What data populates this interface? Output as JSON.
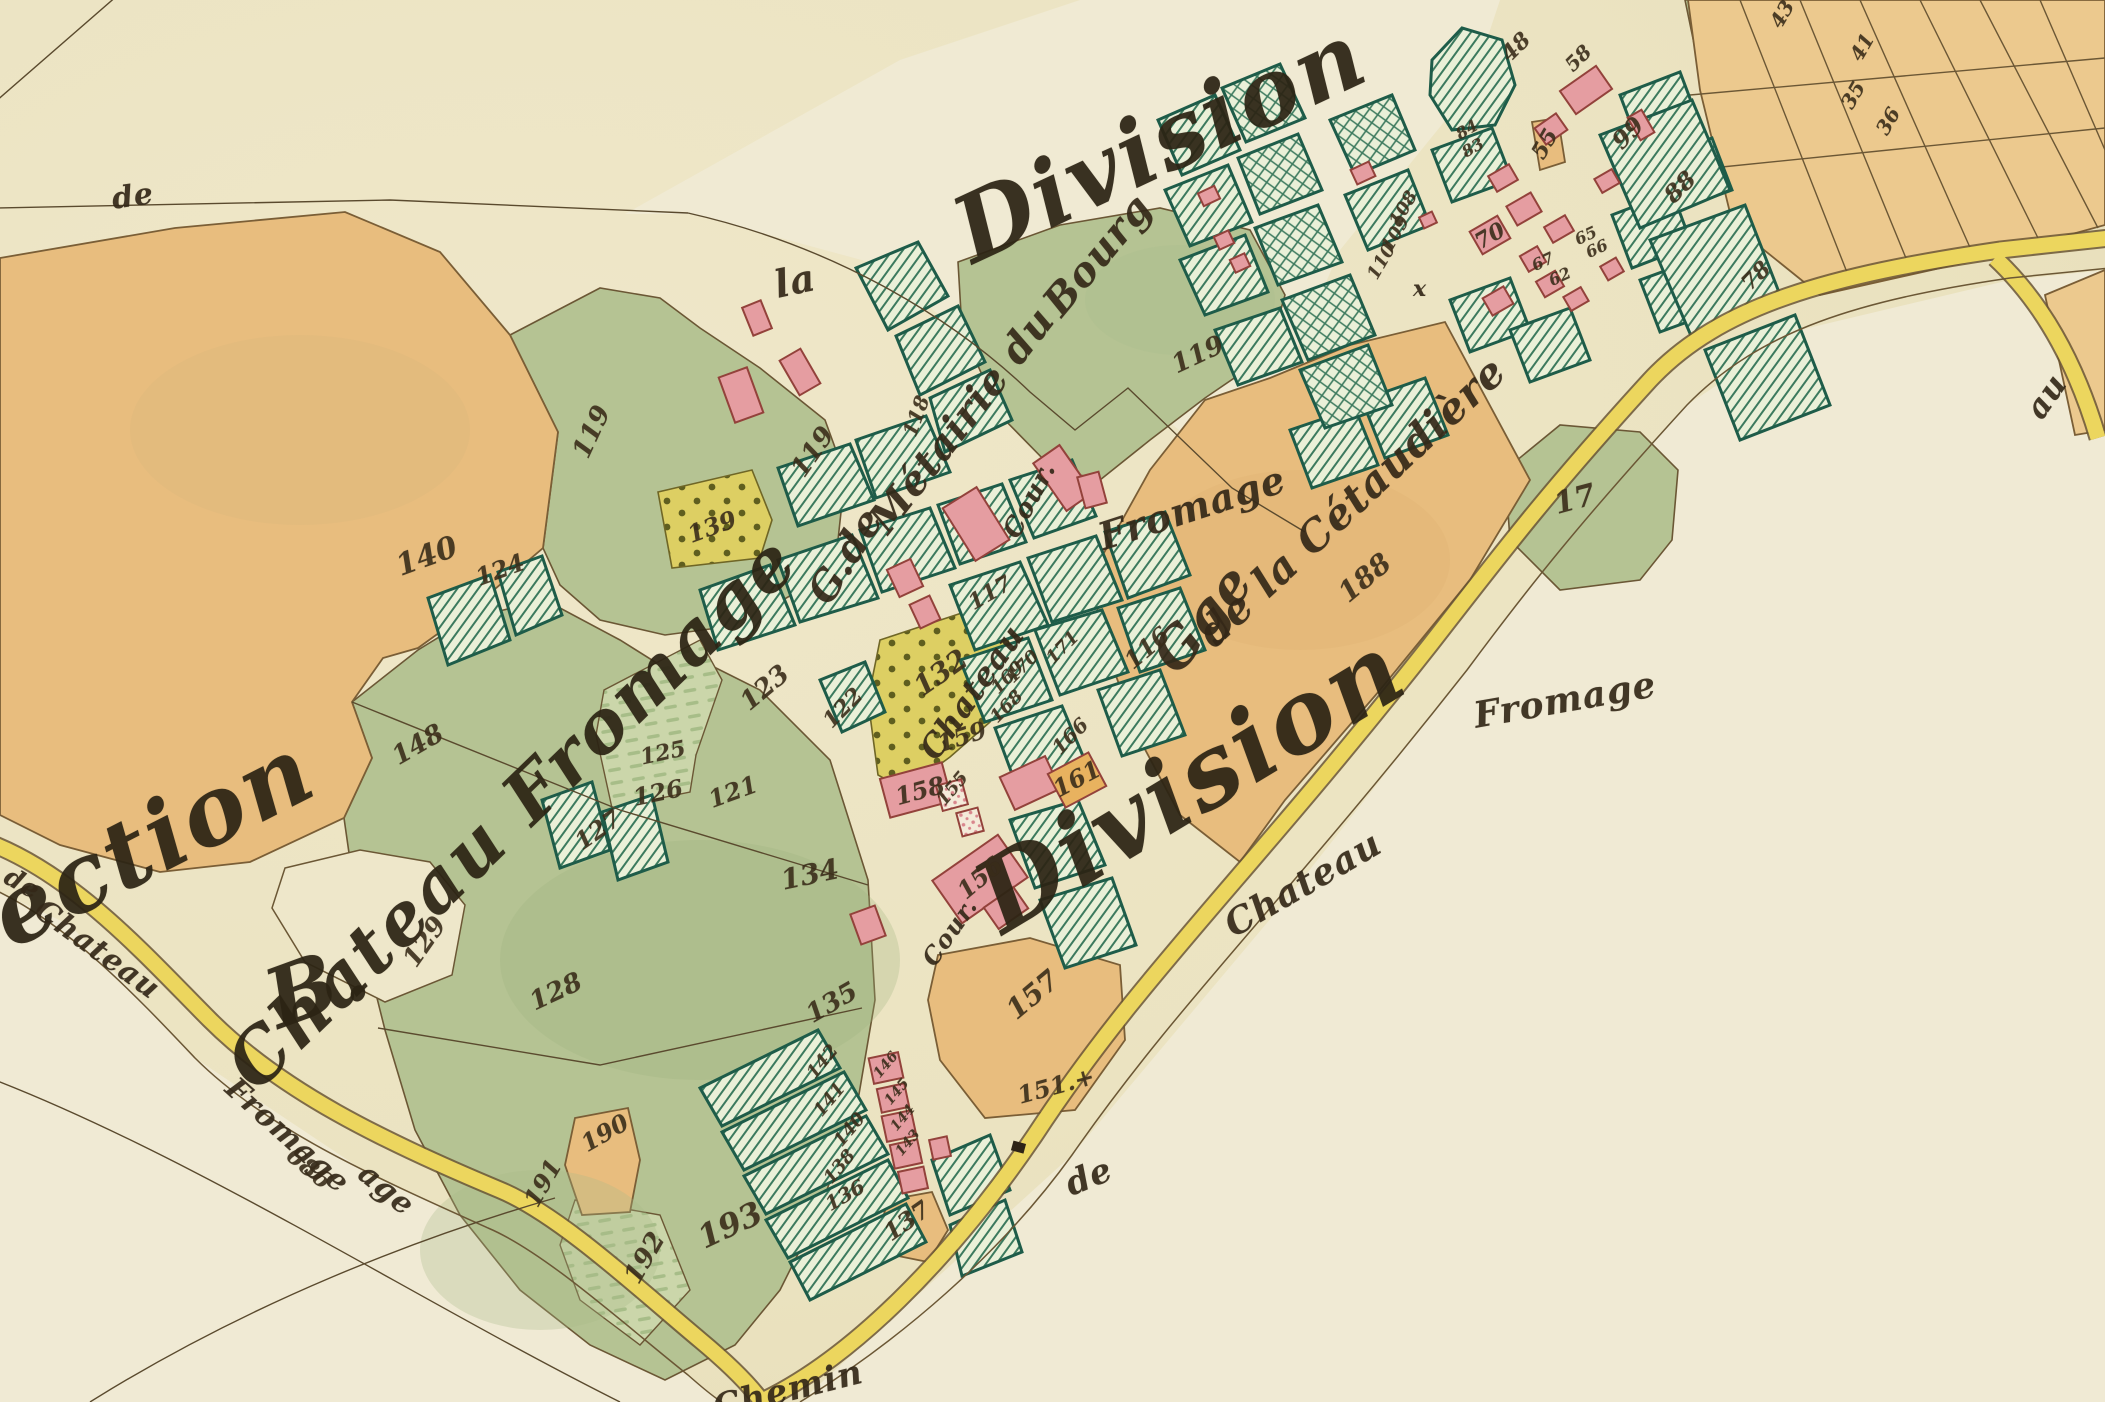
{
  "canvas": {
    "width": 2105,
    "height": 1402
  },
  "palette": {
    "paper": "#ebe3c1",
    "paper_light": "#f1ebd6",
    "field_orange": "#e8bd7e",
    "field_orange_light": "#ecc98e",
    "meadow_green": "#b5c393",
    "stripe_meadow": "#cbd6aa",
    "garden_bg": "#eaf0d8",
    "garden_hatch_line": "#3c7a5e",
    "garden_border": "#1e5c49",
    "building_pink": "#e59da1",
    "building_outline": "#93423b",
    "building_orange": "#e8b25f",
    "road_yellow": "#ecd65e",
    "parcel_yellow": "#ddcf63",
    "ink": "#35291a",
    "boundary_brown": "#6b5735"
  },
  "labels": [
    {
      "text": "Division",
      "x": 1160,
      "y": 142,
      "r": -25,
      "s": 92,
      "c": "title"
    },
    {
      "text": "Division",
      "x": 1190,
      "y": 782,
      "r": -31,
      "s": 100,
      "c": "title"
    },
    {
      "text": "Section",
      "x": 120,
      "y": 858,
      "r": -27,
      "s": 95,
      "c": "title"
    },
    {
      "text": "B.",
      "x": 318,
      "y": 985,
      "r": -20,
      "s": 82,
      "c": "title"
    },
    {
      "text": "Chateau Fromage",
      "x": 512,
      "y": 812,
      "r": -44,
      "s": 72,
      "c": "title"
    },
    {
      "text": "la",
      "x": 795,
      "y": 281,
      "r": -12,
      "s": 38,
      "c": "script"
    },
    {
      "text": "de",
      "x": 133,
      "y": 197,
      "r": -8,
      "s": 30,
      "c": "script"
    },
    {
      "text": "G.de",
      "x": 846,
      "y": 556,
      "r": -58,
      "s": 40,
      "c": "script"
    },
    {
      "text": "Métairie du",
      "x": 962,
      "y": 420,
      "r": -52,
      "s": 40,
      "c": "script"
    },
    {
      "text": "Bourg",
      "x": 1098,
      "y": 255,
      "r": -50,
      "s": 40,
      "c": "script"
    },
    {
      "text": "Gge",
      "x": 1202,
      "y": 618,
      "r": -50,
      "s": 54,
      "c": "script"
    },
    {
      "text": "de la Cétaudière",
      "x": 1352,
      "y": 502,
      "r": -43,
      "s": 42,
      "c": "script"
    },
    {
      "text": "Fromage",
      "x": 1192,
      "y": 508,
      "r": -18,
      "s": 38,
      "c": "script"
    },
    {
      "text": "Fromage",
      "x": 1565,
      "y": 700,
      "r": -10,
      "s": 36,
      "c": "script"
    },
    {
      "text": "Chateau",
      "x": 972,
      "y": 692,
      "r": -55,
      "s": 32,
      "c": "script"
    },
    {
      "text": "Chateau",
      "x": 1303,
      "y": 884,
      "r": -30,
      "s": 36,
      "c": "script"
    },
    {
      "text": "de",
      "x": 1089,
      "y": 1177,
      "r": -22,
      "s": 34,
      "c": "script"
    },
    {
      "text": "Chemin",
      "x": 788,
      "y": 1390,
      "r": -14,
      "s": 34,
      "c": "script"
    },
    {
      "text": "de",
      "x": 22,
      "y": 884,
      "r": 30,
      "s": 26,
      "c": "script"
    },
    {
      "text": "Chateau",
      "x": 97,
      "y": 950,
      "r": 36,
      "s": 30,
      "c": "script"
    },
    {
      "text": "Fromage",
      "x": 287,
      "y": 1136,
      "r": 42,
      "s": 30,
      "c": "script"
    },
    {
      "text": "686",
      "x": 309,
      "y": 1168,
      "r": 40,
      "s": 24,
      "c": "num"
    },
    {
      "text": "age",
      "x": 386,
      "y": 1190,
      "r": 40,
      "s": 30,
      "c": "script"
    },
    {
      "text": "au",
      "x": 2046,
      "y": 396,
      "r": -55,
      "s": 32,
      "c": "script"
    },
    {
      "text": "x",
      "x": 1420,
      "y": 289,
      "r": 0,
      "s": 22,
      "c": "script"
    },
    {
      "text": "Cour.",
      "x": 1030,
      "y": 500,
      "r": -62,
      "s": 26,
      "c": "script"
    },
    {
      "text": "Cour.",
      "x": 950,
      "y": 932,
      "r": -55,
      "s": 24,
      "c": "script"
    },
    {
      "text": "140",
      "x": 427,
      "y": 557,
      "r": -20,
      "s": 30,
      "c": "num"
    },
    {
      "text": "119",
      "x": 592,
      "y": 432,
      "r": -65,
      "s": 26,
      "c": "num"
    },
    {
      "text": "119",
      "x": 813,
      "y": 452,
      "r": -55,
      "s": 26,
      "c": "num"
    },
    {
      "text": "119",
      "x": 1198,
      "y": 355,
      "r": -25,
      "s": 26,
      "c": "num"
    },
    {
      "text": "188",
      "x": 1365,
      "y": 578,
      "r": -40,
      "s": 28,
      "c": "num"
    },
    {
      "text": "17",
      "x": 1575,
      "y": 500,
      "r": -15,
      "s": 30,
      "c": "num"
    },
    {
      "text": "148",
      "x": 418,
      "y": 745,
      "r": -30,
      "s": 26,
      "c": "num"
    },
    {
      "text": "129",
      "x": 425,
      "y": 942,
      "r": -55,
      "s": 26,
      "c": "num"
    },
    {
      "text": "128",
      "x": 556,
      "y": 992,
      "r": -25,
      "s": 26,
      "c": "num"
    },
    {
      "text": "124",
      "x": 500,
      "y": 570,
      "r": -20,
      "s": 24,
      "c": "num"
    },
    {
      "text": "123",
      "x": 765,
      "y": 688,
      "r": -40,
      "s": 26,
      "c": "num"
    },
    {
      "text": "122",
      "x": 843,
      "y": 708,
      "r": -45,
      "s": 22,
      "c": "num"
    },
    {
      "text": "121",
      "x": 733,
      "y": 792,
      "r": -20,
      "s": 24,
      "c": "num"
    },
    {
      "text": "125",
      "x": 663,
      "y": 753,
      "r": -12,
      "s": 22,
      "c": "num"
    },
    {
      "text": "126",
      "x": 658,
      "y": 793,
      "r": -12,
      "s": 24,
      "c": "num"
    },
    {
      "text": "127",
      "x": 598,
      "y": 830,
      "r": -35,
      "s": 24,
      "c": "num"
    },
    {
      "text": "134",
      "x": 810,
      "y": 875,
      "r": -12,
      "s": 28,
      "c": "num"
    },
    {
      "text": "135",
      "x": 832,
      "y": 1003,
      "r": -30,
      "s": 26,
      "c": "num"
    },
    {
      "text": "139",
      "x": 712,
      "y": 527,
      "r": -20,
      "s": 24,
      "c": "num"
    },
    {
      "text": "132",
      "x": 941,
      "y": 673,
      "r": -35,
      "s": 28,
      "c": "num"
    },
    {
      "text": "117",
      "x": 990,
      "y": 593,
      "r": -30,
      "s": 22,
      "c": "num"
    },
    {
      "text": "116",
      "x": 1147,
      "y": 648,
      "r": -40,
      "s": 24,
      "c": "num"
    },
    {
      "text": "118",
      "x": 916,
      "y": 416,
      "r": -70,
      "s": 20,
      "c": "num"
    },
    {
      "text": "110",
      "x": 1382,
      "y": 262,
      "r": -60,
      "s": 18,
      "c": "num"
    },
    {
      "text": "109",
      "x": 1396,
      "y": 234,
      "r": -60,
      "s": 18,
      "c": "num"
    },
    {
      "text": "108",
      "x": 1404,
      "y": 209,
      "r": -60,
      "s": 18,
      "c": "num"
    },
    {
      "text": "70",
      "x": 1490,
      "y": 236,
      "r": -30,
      "s": 22,
      "c": "num"
    },
    {
      "text": "55",
      "x": 1545,
      "y": 144,
      "r": -60,
      "s": 22,
      "c": "num"
    },
    {
      "text": "48",
      "x": 1516,
      "y": 47,
      "r": -45,
      "s": 22,
      "c": "num"
    },
    {
      "text": "58",
      "x": 1578,
      "y": 58,
      "r": -45,
      "s": 20,
      "c": "num"
    },
    {
      "text": "99",
      "x": 1628,
      "y": 133,
      "r": -45,
      "s": 24,
      "c": "num"
    },
    {
      "text": "88",
      "x": 1680,
      "y": 187,
      "r": -45,
      "s": 24,
      "c": "num"
    },
    {
      "text": "78",
      "x": 1756,
      "y": 276,
      "r": -45,
      "s": 22,
      "c": "num"
    },
    {
      "text": "84",
      "x": 1467,
      "y": 130,
      "r": -30,
      "s": 16,
      "c": "num"
    },
    {
      "text": "83",
      "x": 1473,
      "y": 148,
      "r": -30,
      "s": 16,
      "c": "num"
    },
    {
      "text": "65",
      "x": 1586,
      "y": 236,
      "r": -25,
      "s": 16,
      "c": "num"
    },
    {
      "text": "66",
      "x": 1597,
      "y": 249,
      "r": -25,
      "s": 16,
      "c": "num"
    },
    {
      "text": "62",
      "x": 1560,
      "y": 277,
      "r": -25,
      "s": 16,
      "c": "num"
    },
    {
      "text": "67",
      "x": 1543,
      "y": 262,
      "r": -25,
      "s": 16,
      "c": "num"
    },
    {
      "text": "43",
      "x": 1782,
      "y": 14,
      "r": -60,
      "s": 20,
      "c": "num"
    },
    {
      "text": "41",
      "x": 1862,
      "y": 47,
      "r": -60,
      "s": 20,
      "c": "num"
    },
    {
      "text": "35",
      "x": 1853,
      "y": 95,
      "r": -60,
      "s": 20,
      "c": "num"
    },
    {
      "text": "36",
      "x": 1888,
      "y": 121,
      "r": -60,
      "s": 20,
      "c": "num"
    },
    {
      "text": "190",
      "x": 605,
      "y": 1133,
      "r": -30,
      "s": 24,
      "c": "num"
    },
    {
      "text": "191",
      "x": 543,
      "y": 1183,
      "r": -60,
      "s": 24,
      "c": "num"
    },
    {
      "text": "192",
      "x": 645,
      "y": 1258,
      "r": -60,
      "s": 26,
      "c": "num"
    },
    {
      "text": "193",
      "x": 730,
      "y": 1225,
      "r": -25,
      "s": 32,
      "c": "num"
    },
    {
      "text": "137",
      "x": 907,
      "y": 1221,
      "r": -35,
      "s": 24,
      "c": "num"
    },
    {
      "text": "157",
      "x": 1033,
      "y": 995,
      "r": -40,
      "s": 28,
      "c": "num"
    },
    {
      "text": "151.+",
      "x": 1056,
      "y": 1086,
      "r": -15,
      "s": 24,
      "c": "num"
    },
    {
      "text": "158",
      "x": 920,
      "y": 791,
      "r": -15,
      "s": 24,
      "c": "num"
    },
    {
      "text": "159",
      "x": 962,
      "y": 737,
      "r": -18,
      "s": 24,
      "c": "num"
    },
    {
      "text": "155",
      "x": 953,
      "y": 789,
      "r": -50,
      "s": 18,
      "c": "num"
    },
    {
      "text": "156",
      "x": 980,
      "y": 878,
      "r": -40,
      "s": 24,
      "c": "num"
    },
    {
      "text": "161",
      "x": 1077,
      "y": 779,
      "r": -28,
      "s": 24,
      "c": "num"
    },
    {
      "text": "166",
      "x": 1070,
      "y": 736,
      "r": -45,
      "s": 20,
      "c": "num"
    },
    {
      "text": "168",
      "x": 1007,
      "y": 707,
      "r": -45,
      "s": 18,
      "c": "num"
    },
    {
      "text": "169",
      "x": 1008,
      "y": 678,
      "r": -45,
      "s": 18,
      "c": "num"
    },
    {
      "text": "170",
      "x": 1023,
      "y": 667,
      "r": -45,
      "s": 18,
      "c": "num"
    },
    {
      "text": "171",
      "x": 1063,
      "y": 648,
      "r": -45,
      "s": 18,
      "c": "num"
    },
    {
      "text": "142",
      "x": 823,
      "y": 1062,
      "r": -50,
      "s": 18,
      "c": "num"
    },
    {
      "text": "141",
      "x": 830,
      "y": 1100,
      "r": -50,
      "s": 18,
      "c": "num"
    },
    {
      "text": "140",
      "x": 850,
      "y": 1130,
      "r": -50,
      "s": 18,
      "c": "num"
    },
    {
      "text": "138",
      "x": 840,
      "y": 1167,
      "r": -50,
      "s": 18,
      "c": "num"
    },
    {
      "text": "136",
      "x": 845,
      "y": 1195,
      "r": -30,
      "s": 20,
      "c": "num"
    },
    {
      "text": "146",
      "x": 886,
      "y": 1065,
      "r": -50,
      "s": 14,
      "c": "num"
    },
    {
      "text": "145",
      "x": 897,
      "y": 1092,
      "r": -50,
      "s": 14,
      "c": "num"
    },
    {
      "text": "144",
      "x": 903,
      "y": 1118,
      "r": -50,
      "s": 14,
      "c": "num"
    },
    {
      "text": "143",
      "x": 908,
      "y": 1143,
      "r": -50,
      "s": 14,
      "c": "num"
    }
  ]
}
